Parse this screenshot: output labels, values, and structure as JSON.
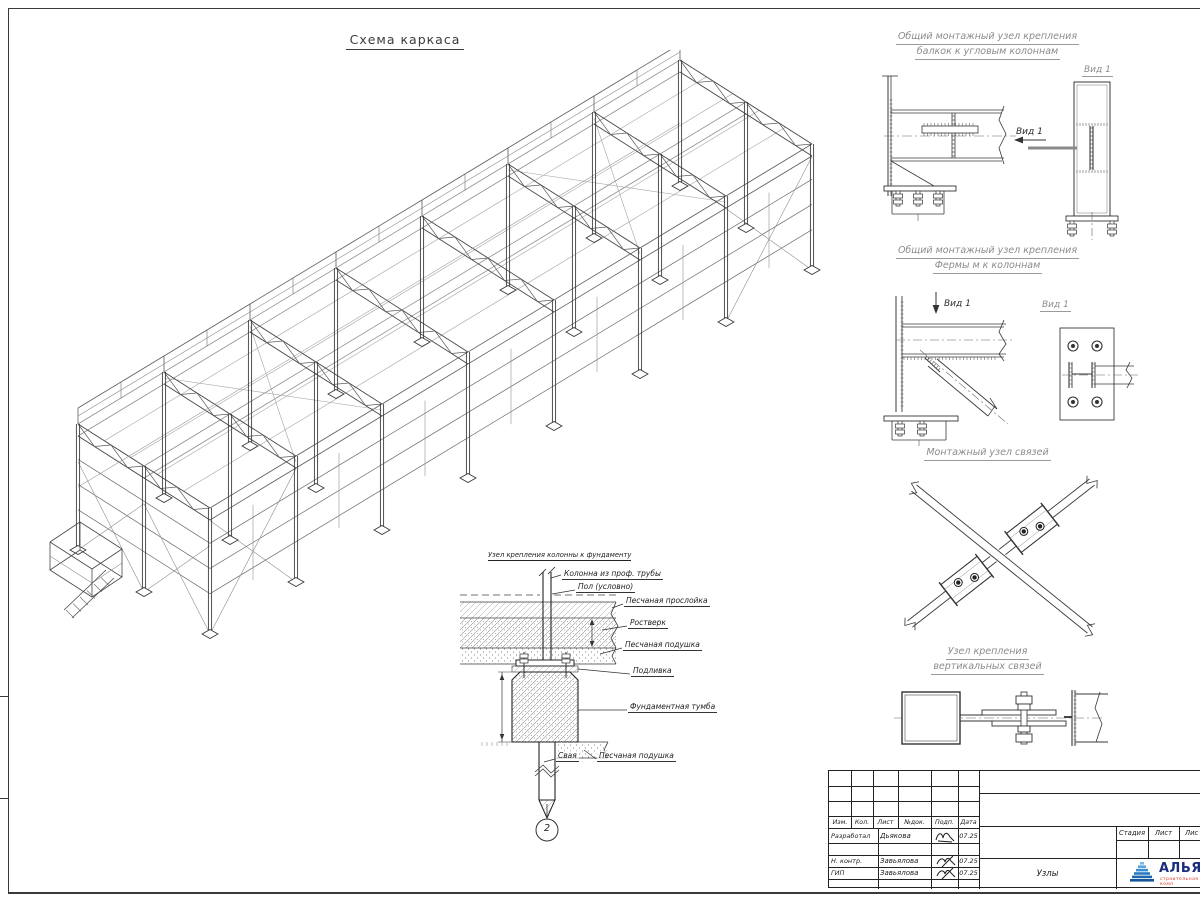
{
  "colors": {
    "line": "#3a3a3a",
    "secondary_line": "#9a9a9a",
    "heading": "#8c8c8c",
    "logo_blue": "#2a7ac0",
    "logo_text_blue": "#1b2d7f",
    "logo_sub_red": "#d93a2b"
  },
  "main_view": {
    "title": "Схема каркаса"
  },
  "details": {
    "d1": {
      "title1": "Общий монтажный узел крепления",
      "title2": "балкок к угловым колоннам",
      "view_arrow_label": "Вид 1",
      "view_title": "Вид 1"
    },
    "d2": {
      "title1": "Общий монтажный узел крепления",
      "title2": "Фермы м к колоннам",
      "view_arrow_label": "Вид 1",
      "view_title": "Вид 1"
    },
    "d3": {
      "title": "Монтажный узел связей"
    },
    "d4": {
      "title1": "Узел крепления",
      "title2": "вертикальных связей"
    }
  },
  "foundation": {
    "title": "Узел крепления колонны к фундаменту",
    "labels": {
      "column": "Колонна из проф. трубы",
      "floor": "Пол (условно)",
      "sand_layer": "Песчаная прослойка",
      "grillage": "Ростверк",
      "sand_cushion1": "Песчаная подушка",
      "grout": "Подливка",
      "block": "Фундаментная тумба",
      "pile": "Свая",
      "sand_cushion2": "Песчаная подушка"
    },
    "marker": "2"
  },
  "title_block": {
    "rev_headers": [
      "Изм.",
      "Кол.",
      "Лист",
      "№док.",
      "Подп.",
      "Дата"
    ],
    "people": [
      {
        "role": "Разработал",
        "name": "Дьякова",
        "date": "07.25"
      },
      {
        "role": "Н. контр.",
        "name": "Завьялова",
        "date": "07.25"
      },
      {
        "role": "ГИП",
        "name": "Завьялова",
        "date": "07.25"
      }
    ],
    "stage_headers": [
      "Стадия",
      "Лист",
      "Лис"
    ],
    "doc_title": "Узлы",
    "logo": {
      "text": "АЛЬЯН",
      "subtext": "строительная комп"
    }
  }
}
